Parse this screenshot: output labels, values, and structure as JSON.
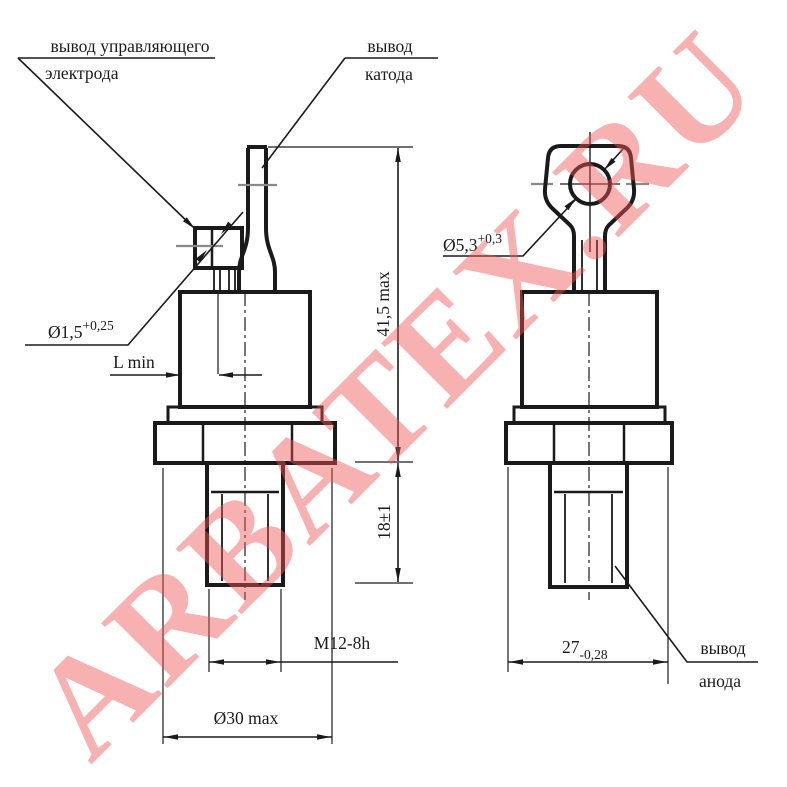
{
  "watermark": {
    "text": "ARBATEX.RU",
    "color": "#f05555"
  },
  "labels": {
    "gate_line1": "вывод управляющего",
    "gate_line2": "электрода",
    "cathode_line1": "вывод",
    "cathode_line2": "катода",
    "anode_line1": "вывод",
    "anode_line2": "анода"
  },
  "dimensions": {
    "gate_wire_dia": "Ø1,5",
    "gate_wire_tol": "+0,25",
    "l_min": "L min",
    "total_height": "41,5 max",
    "stud_length": "18±1",
    "thread": "M12-8h",
    "body_dia": "Ø30 max",
    "hole_dia": "Ø5,3",
    "hole_tol": "+0,3",
    "flat_width": "27",
    "flat_width_tol": "-0,28"
  }
}
